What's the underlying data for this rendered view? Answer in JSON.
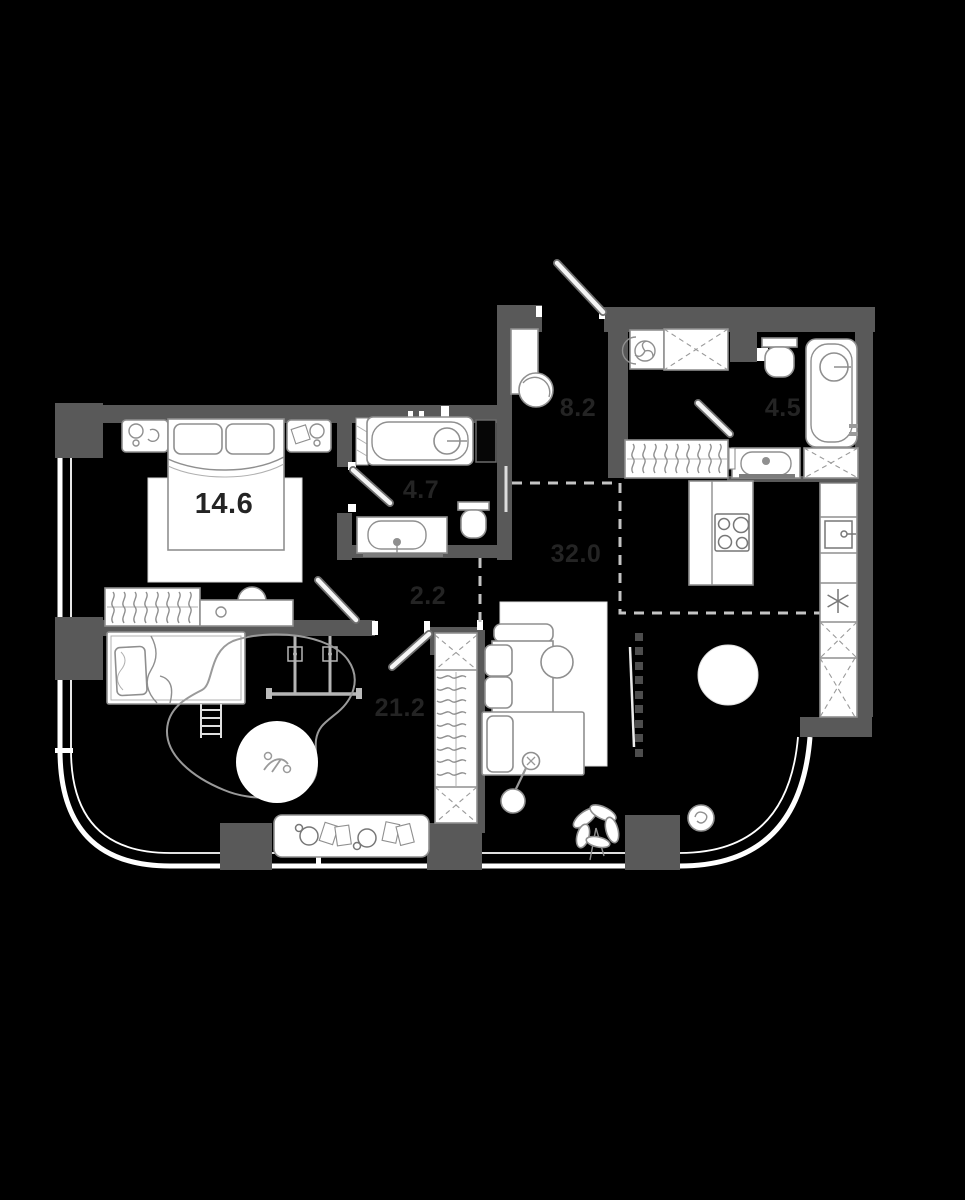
{
  "plan": {
    "type": "apartment-floor-plan",
    "colors": {
      "background": "#000000",
      "wall": "#595959",
      "window_line": "#ffffff",
      "fixture_stroke": "#8f8f8f",
      "zone_dash": "#c4c4c4",
      "label": "#242424"
    },
    "rooms": [
      {
        "id": "bedroom",
        "area": "14.6"
      },
      {
        "id": "ensuite-bathroom",
        "area": "4.7"
      },
      {
        "id": "entrance-hall",
        "area": "8.2"
      },
      {
        "id": "bathroom",
        "area": "4.5"
      },
      {
        "id": "corridor",
        "area": "2.2"
      },
      {
        "id": "children-room",
        "area": "21.2"
      },
      {
        "id": "living-kitchen",
        "area": "32.0"
      }
    ]
  }
}
